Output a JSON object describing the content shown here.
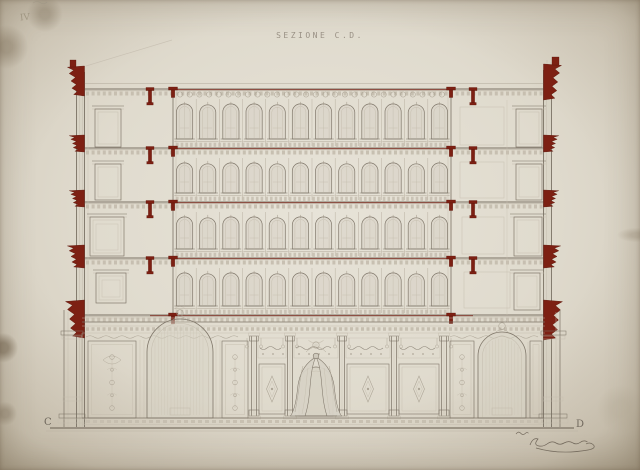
{
  "sheet": {
    "title": "SEZIONE C.D.",
    "corner_mark": "IV",
    "marker_left": "C",
    "marker_right": "D"
  },
  "palette": {
    "paper": "#ddd8ca",
    "ink": "#7b7265",
    "ink_light": "#a59c8d",
    "faint": "#c3bbac",
    "wash": "rgba(210,205,192,.45)",
    "red": "#7d2013",
    "red_dark": "#591308",
    "red_line": "#8d4036",
    "pencil": "#8c8270"
  },
  "drawing": {
    "type": "architectural-cross-section",
    "storeys": 4,
    "floor_lines_y": [
      89,
      148,
      202,
      258,
      315
    ],
    "ground_line_y": 428,
    "arcade": {
      "x1": 173,
      "x2": 451,
      "arches_per_row": 12,
      "rows": 4
    },
    "left_wall": {
      "x1": 76.5,
      "x2": 84.5,
      "top_y": 66
    },
    "right_wall": {
      "x1": 543.5,
      "x2": 551.5,
      "top_y": 64
    },
    "cornices_left": [
      [
        66,
        18,
        30
      ],
      [
        135,
        16,
        17
      ],
      [
        190,
        16,
        17
      ],
      [
        245,
        18,
        23
      ],
      [
        300,
        20,
        38
      ]
    ],
    "cornices_right": [
      [
        64,
        19,
        36
      ],
      [
        135,
        16,
        17
      ],
      [
        190,
        16,
        17
      ],
      [
        245,
        18,
        23
      ],
      [
        300,
        20,
        40
      ]
    ],
    "anchors_x": [
      173,
      451
    ],
    "hangers_x": [
      150,
      473
    ],
    "doors_left": [
      [
        95,
        106,
        26,
        41
      ],
      [
        95,
        161,
        26,
        39
      ],
      [
        90,
        214,
        34,
        42
      ],
      [
        96,
        270,
        30,
        33
      ]
    ],
    "doors_right": [
      [
        516,
        106,
        26,
        41
      ],
      [
        516,
        161,
        26,
        39
      ],
      [
        514,
        214,
        28,
        42
      ],
      [
        514,
        270,
        26,
        40
      ]
    ],
    "panels_right_rooms": [
      [
        460,
        107,
        44,
        38
      ],
      [
        460,
        162,
        44,
        36
      ],
      [
        462,
        217,
        42,
        37
      ],
      [
        464,
        272,
        46,
        36
      ]
    ],
    "ground": {
      "entablature_y": 322,
      "columns_x": [
        254,
        290,
        342,
        394,
        444
      ],
      "portal": {
        "x1": 299,
        "x2": 333,
        "spring_y": 384,
        "r": 17,
        "base_y": 416
      },
      "niche_left": {
        "x1": 147,
        "x2": 213,
        "spring_y": 352,
        "base_y": 418
      },
      "niche_right": {
        "x1": 478,
        "x2": 526,
        "spring_y": 356,
        "base_y": 418
      },
      "panels_left": [
        [
          88,
          341,
          48,
          77
        ],
        [
          222,
          341,
          26,
          77
        ]
      ],
      "panels_right": [
        [
          450,
          341,
          24,
          77
        ],
        [
          530,
          341,
          12,
          77
        ]
      ],
      "base_y": 418
    }
  }
}
